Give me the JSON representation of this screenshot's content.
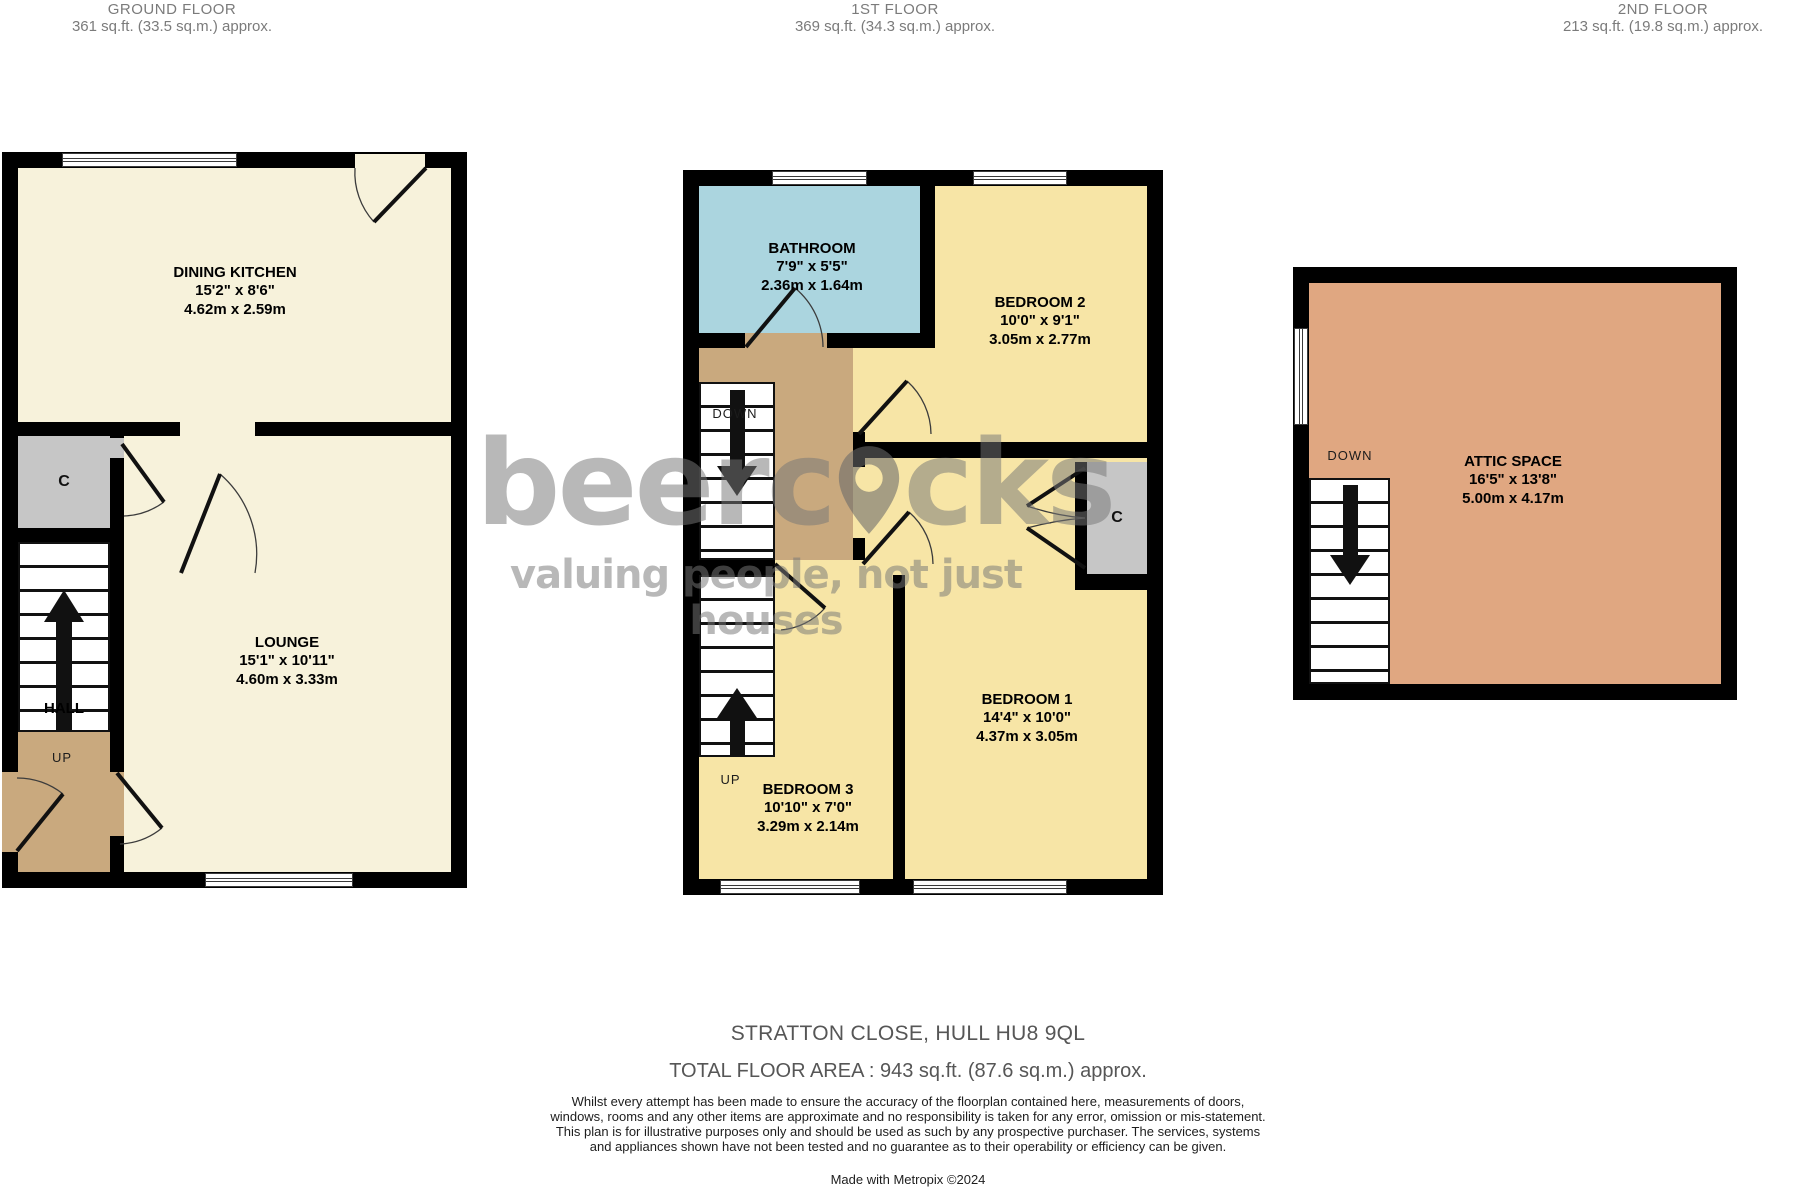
{
  "floors": {
    "ground": {
      "title": "GROUND FLOOR",
      "area": "361 sq.ft. (33.5 sq.m.) approx."
    },
    "first": {
      "title": "1ST FLOOR",
      "area": "369 sq.ft. (34.3 sq.m.) approx."
    },
    "second": {
      "title": "2ND FLOOR",
      "area": "213 sq.ft. (19.8 sq.m.) approx."
    }
  },
  "rooms": {
    "dining_kitchen": {
      "name": "DINING KITCHEN",
      "imperial": "15'2\"  x 8'6\"",
      "metric": "4.62m  x 2.59m"
    },
    "lounge": {
      "name": "LOUNGE",
      "imperial": "15'1\"  x 10'11\"",
      "metric": "4.60m  x 3.33m"
    },
    "bathroom": {
      "name": "BATHROOM",
      "imperial": "7'9\"  x 5'5\"",
      "metric": "2.36m  x 1.64m"
    },
    "bedroom2": {
      "name": "BEDROOM 2",
      "imperial": "10'0\"  x 9'1\"",
      "metric": "3.05m  x 2.77m"
    },
    "bedroom1": {
      "name": "BEDROOM 1",
      "imperial": "14'4\"  x 10'0\"",
      "metric": "4.37m  x 3.05m"
    },
    "bedroom3": {
      "name": "BEDROOM 3",
      "imperial": "10'10\"  x 7'0\"",
      "metric": "3.29m  x 2.14m"
    },
    "attic": {
      "name": "ATTIC SPACE",
      "imperial": "16'5\"  x 13'8\"",
      "metric": "5.00m  x 4.17m"
    }
  },
  "labels": {
    "hall": "HALL",
    "up": "UP",
    "down": "DOWN",
    "cupboard": "C"
  },
  "watermark": {
    "brand_prefix": "beerc",
    "brand_suffix": "cks",
    "tagline": "valuing people, not just houses"
  },
  "footer": {
    "address": "STRATTON CLOSE, HULL HU8 9QL",
    "total_area": "TOTAL FLOOR AREA : 943 sq.ft. (87.6 sq.m.) approx.",
    "disclaimer": "Whilst every attempt has been made to ensure the accuracy of the floorplan contained here, measurements of doors, windows, rooms and any other items are approximate and no responsibility is taken for any error, omission or mis-statement. This plan is for illustrative purposes only and should be used as such by any prospective purchaser. The services, systems and appliances shown have not been tested and no guarantee as to their operability or efficiency can be given.",
    "credit": "Made with Metropix ©2024"
  },
  "colors": {
    "cream": "#F7F2DB",
    "bedroom_yellow": "#F7E5A6",
    "bathroom_blue": "#ABD5DF",
    "hall_tan": "#C9A97E",
    "attic_salmon": "#E0A781",
    "cupboard_gray": "#C6C6C6",
    "wall_black": "#000000"
  }
}
